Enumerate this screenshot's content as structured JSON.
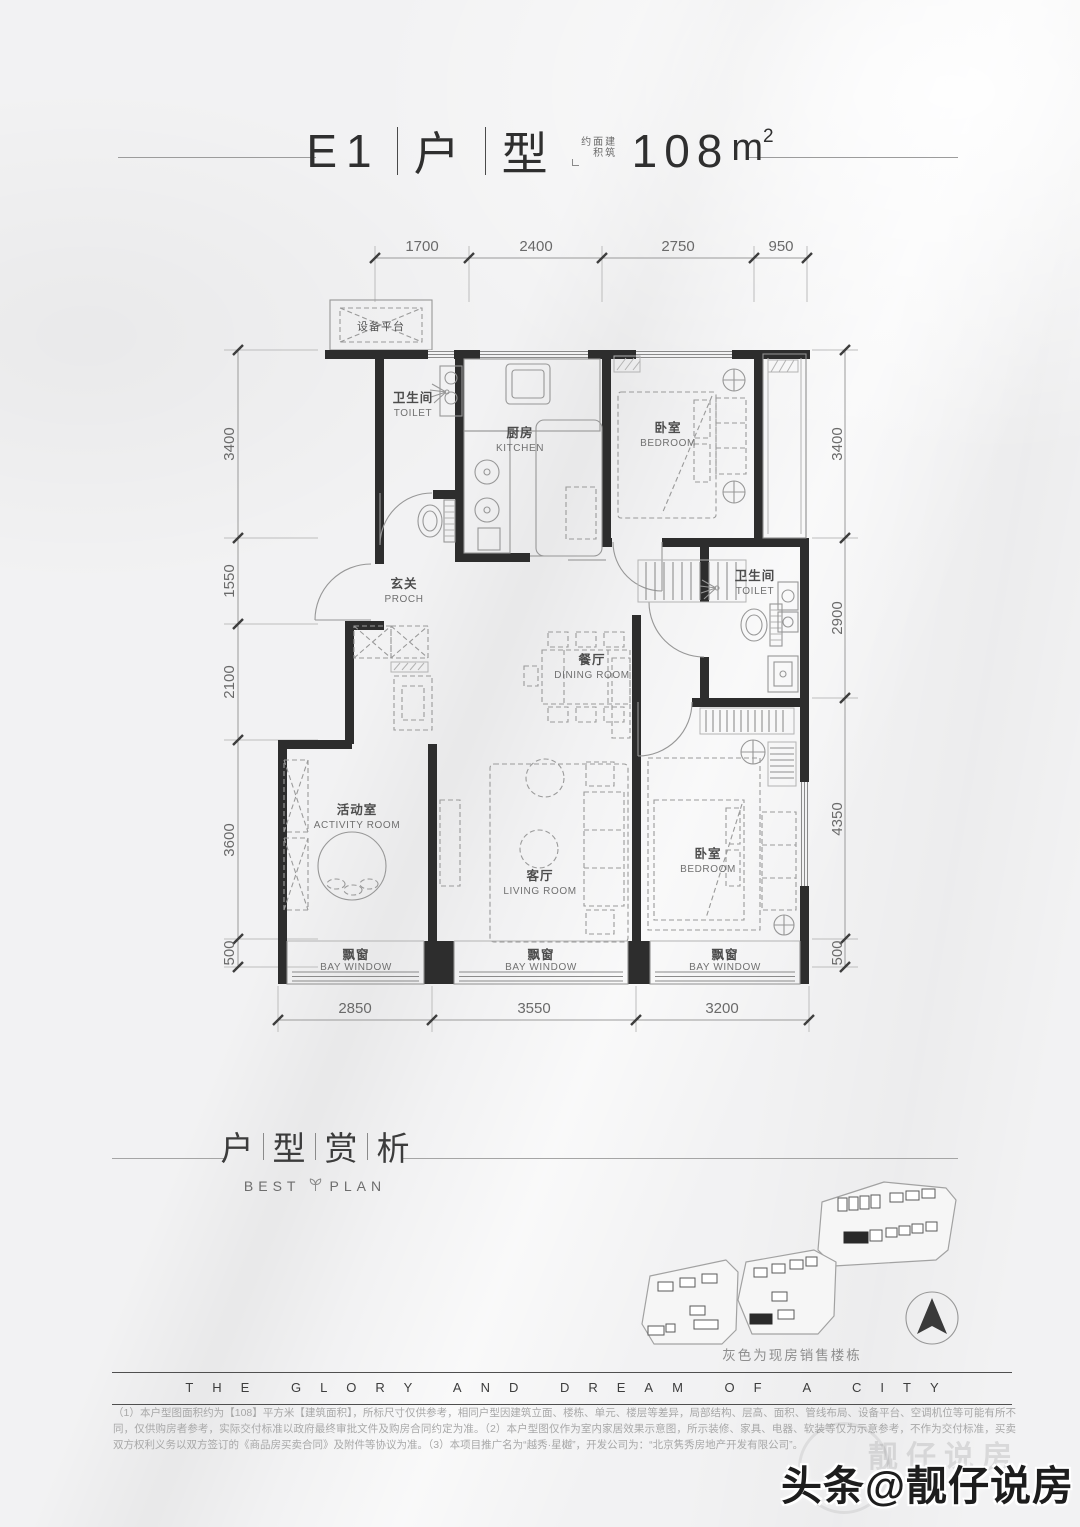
{
  "colors": {
    "wall": "#2d2d2d",
    "background": "#f2f2f3",
    "text_dark": "#3c3c3c"
  },
  "header": {
    "unit": "E1",
    "type1": "户",
    "type2": "型",
    "note_cols": [
      "建筑",
      "面积",
      "约"
    ],
    "area_value": "108",
    "area_unit": "m",
    "area_sup": "2"
  },
  "floorplan": {
    "equipment_platform": "设备平台",
    "rooms": {
      "toilet1": {
        "zh": "卫生间",
        "en": "TOILET"
      },
      "kitchen": {
        "zh": "厨房",
        "en": "KITCHEN"
      },
      "bedroom1": {
        "zh": "卧室",
        "en": "BEDROOM"
      },
      "porch": {
        "zh": "玄关",
        "en": "PROCH"
      },
      "dining": {
        "zh": "餐厅",
        "en": "DINING ROOM"
      },
      "toilet2": {
        "zh": "卫生间",
        "en": "TOILET"
      },
      "activity": {
        "zh": "活动室",
        "en": "ACTIVITY ROOM"
      },
      "living": {
        "zh": "客厅",
        "en": "LIVING ROOM"
      },
      "bedroom2": {
        "zh": "卧室",
        "en": "BEDROOM"
      },
      "bay": {
        "zh": "飘窗",
        "en": "BAY WINDOW"
      }
    },
    "dimensions": {
      "top": [
        "1700",
        "2400",
        "2750",
        "950"
      ],
      "left": [
        "3400",
        "1550",
        "2100",
        "3600",
        "500"
      ],
      "right": [
        "3400",
        "2900",
        "4350",
        "500"
      ],
      "bottom": [
        "2850",
        "3550",
        "3200"
      ]
    }
  },
  "section_header": {
    "zh": [
      "户",
      "型",
      "赏",
      "析"
    ],
    "en_left": "BEST",
    "en_right": "PLAN"
  },
  "siteplan": {
    "caption": "灰色为现房销售楼栋"
  },
  "banner": {
    "text": "THE GLORY AND DREAM OF A CITY"
  },
  "disclaimer": {
    "text": "（1）本户型图面积约为【108】平方米【建筑面积】，所标尺寸仅供参考，相同户型因建筑立面、楼栋、单元、楼层等差异，局部结构、层高、面积、管线布局、设备平台、空调机位等可能有所不同，仅供购房者参考，实际交付标准以政府最终审批文件及购房合同约定为准。（2）本户型图仅作为室内家居效果示意图，所示装修、家具、电器、软装等仅为示意参考，不作为交付标准，买卖双方权利义务以双方签订的《商品房买卖合同》及附件等协议为准。（3）本项目推广名为“越秀·星樾”，开发公司为：“北京隽秀房地产开发有限公司”。"
  },
  "watermark": {
    "platform": "头条",
    "handle": "@靓仔说房",
    "ghost": "靓仔说房"
  }
}
